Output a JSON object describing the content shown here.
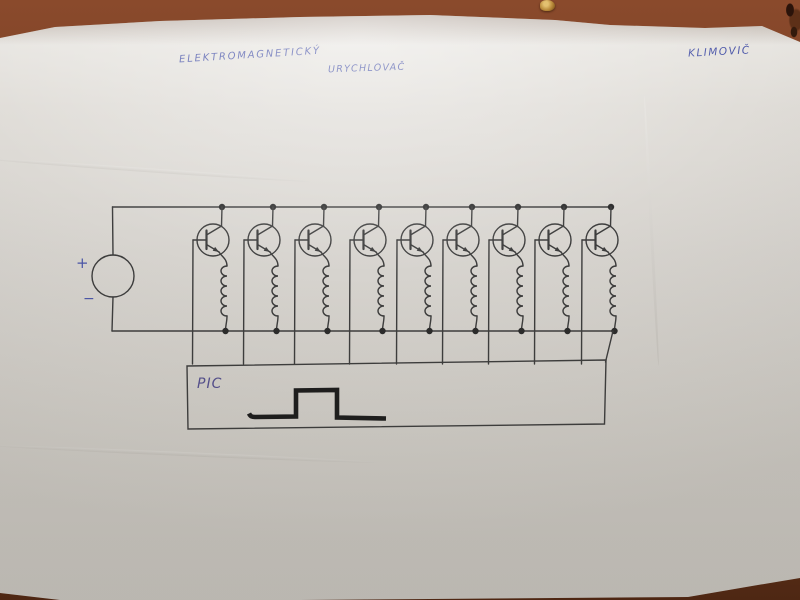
{
  "handwriting": {
    "title_word1": "ELEKTROMAGNETICKÝ",
    "title_word2": "URYCHLOVAČ",
    "author": "KLIMOVIČ",
    "plus": "+",
    "minus": "−",
    "controller": "PIC"
  },
  "schematic": {
    "stage_count": 9,
    "description_labels": {
      "power_source": "circle source symbol with + and − marks",
      "stage": "NPN transistor with series coil between supply rails",
      "controller": "PIC box with square pulse waveform"
    }
  },
  "colors": {
    "table": "#7e4226",
    "paper": "#d6d3ce",
    "ink": "#3d3d3d",
    "pen_blue": "#4a55a8",
    "pulse_black": "#1c1c1c"
  }
}
